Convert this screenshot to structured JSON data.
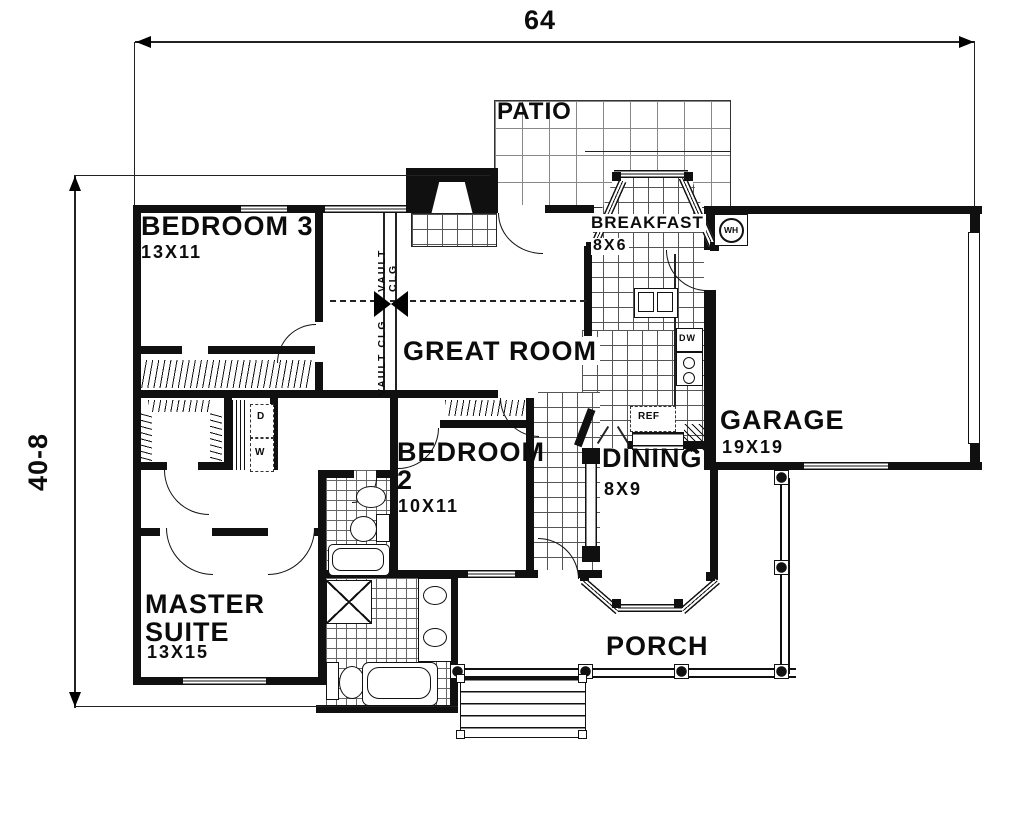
{
  "dims": {
    "width_label": "64",
    "height_label": "40-8"
  },
  "rooms": {
    "patio": {
      "name": "PATIO"
    },
    "bedroom3": {
      "name": "BEDROOM 3",
      "size": "13X11"
    },
    "great_room": {
      "name": "GREAT ROOM"
    },
    "breakfast": {
      "name": "BREAKFAST",
      "size": "8X6"
    },
    "garage": {
      "name": "GARAGE",
      "size": "19X19"
    },
    "bedroom2": {
      "name": "BEDROOM\n2",
      "size": "10X11"
    },
    "dining": {
      "name": "DINING",
      "size": "8X9"
    },
    "master_suite": {
      "name": "MASTER\nSUITE",
      "size": "13X15"
    },
    "porch": {
      "name": "PORCH"
    }
  },
  "labels": {
    "vault_clg": "VAULT CLG",
    "water_heater": "WH",
    "dishwasher": "DW",
    "refrigerator": "REF",
    "dryer": "D",
    "washer": "W"
  },
  "colors": {
    "ink": "#111111",
    "paper": "#ffffff"
  }
}
